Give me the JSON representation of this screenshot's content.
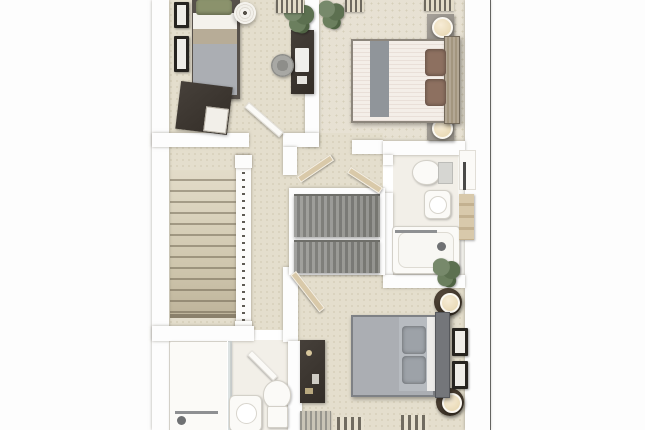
{
  "image": {
    "kind": "3d-floor-plan-render",
    "view": "top-down dollhouse cutaway of an upper storey",
    "visible_text": []
  },
  "palette": {
    "wall": "#fdfdfd",
    "carpet": "#e4decd",
    "carpet_b": "#e7e1d3",
    "carpet_speck": "#d6cfba",
    "bath_floor": "#f2efe8",
    "border_left": "#b8b8b8",
    "border_right": "#636363",
    "door_tan": "#d9c9a9",
    "wood_dark": "#3e3730",
    "wood_grey": "#8b8b87",
    "duvet_grey": "#abaeb3",
    "duvet_cream": "#f2ebe5",
    "runner_grey": "#90959a",
    "pillow_brown": "#8d7060",
    "pillow_green": "#8b926c",
    "plant_green": "#5c7050",
    "lamp_cream": "#eadbb9",
    "fixture_white": "#fbfaf7",
    "chrome": "#8e9092"
  },
  "rooms": [
    {
      "id": "bedroom-top-left",
      "contents": [
        "single-bed-green-pillow",
        "chest-of-drawers",
        "desk-with-computer",
        "desk-chair",
        "pendant-light",
        "two-wall-frames",
        "plant",
        "slatted-radiator"
      ]
    },
    {
      "id": "bedroom-top-right",
      "contents": [
        "double-bed-cream-striped",
        "grey-bed-runner",
        "two-brown-pillows",
        "two-nightstands-with-lamps",
        "plant",
        "two-slatted-radiators"
      ]
    },
    {
      "id": "family-bathroom-right",
      "contents": [
        "toilet-with-cistern",
        "basin",
        "bathtub-with-shower",
        "towel-rail",
        "towel-stack",
        "wall-cabinet"
      ]
    },
    {
      "id": "landing-centre",
      "contents": [
        "staircase",
        "balustrade-with-spindles",
        "double-storage-cupboard-grey",
        "open-doors"
      ]
    },
    {
      "id": "bedroom-bottom-right",
      "contents": [
        "double-bed-grey",
        "two-round-nightstands-with-lamps",
        "dressing-table",
        "two-wall-frames",
        "plant",
        "two-striped-rugs",
        "radiator"
      ]
    },
    {
      "id": "ensuite-bottom-left",
      "contents": [
        "shower-enclosure-with-glass",
        "basin",
        "toilet"
      ]
    }
  ]
}
